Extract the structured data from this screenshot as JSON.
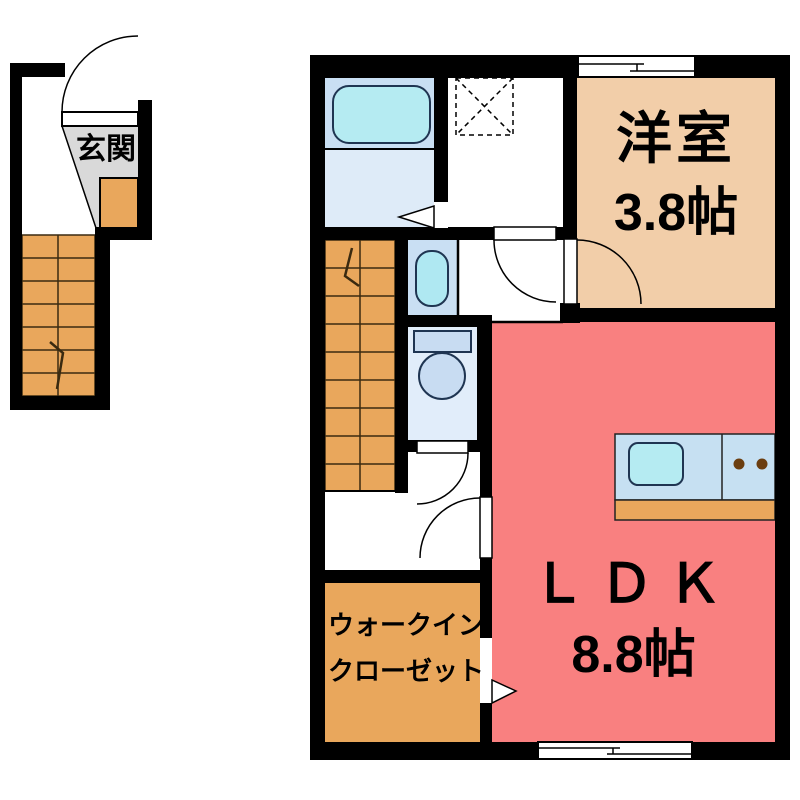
{
  "floor_plan": {
    "rooms": {
      "entrance": {
        "name": "玄関"
      },
      "western_room": {
        "name": "洋室",
        "size": "3.8帖"
      },
      "ldk": {
        "name": "ＬＤＫ",
        "size": "8.8帖"
      },
      "walk_in_closet": {
        "name_line1": "ウォークイン",
        "name_line2": "クローゼット"
      }
    },
    "colors": {
      "wall": "#000000",
      "western_room_floor": "#F2CEA9",
      "ldk_floor": "#F98080",
      "closet_floor": "#E9A75C",
      "stairs_floor": "#E9A75C",
      "entrance_step": "#E9A75C",
      "entrance_floor": "#D9D9D9",
      "bathroom_floor": "#C9DFF3",
      "washroom_floor": "#DEEBF8",
      "washbasin_room_floor": "#C9DFF3",
      "toilet_floor": "#E1EDFA",
      "bathtub_fill": "#B5EBF2",
      "washbasin_fill": "#AFE8F2",
      "toilet_fixture_fill": "#C8DCF2",
      "counter_fill": "#C6E0F2",
      "sink_fill": "#B5EBF2",
      "counter_base": "#E9A75C",
      "burner_brown": "#6B3E10",
      "floor_white": "#FFFFFF"
    }
  }
}
